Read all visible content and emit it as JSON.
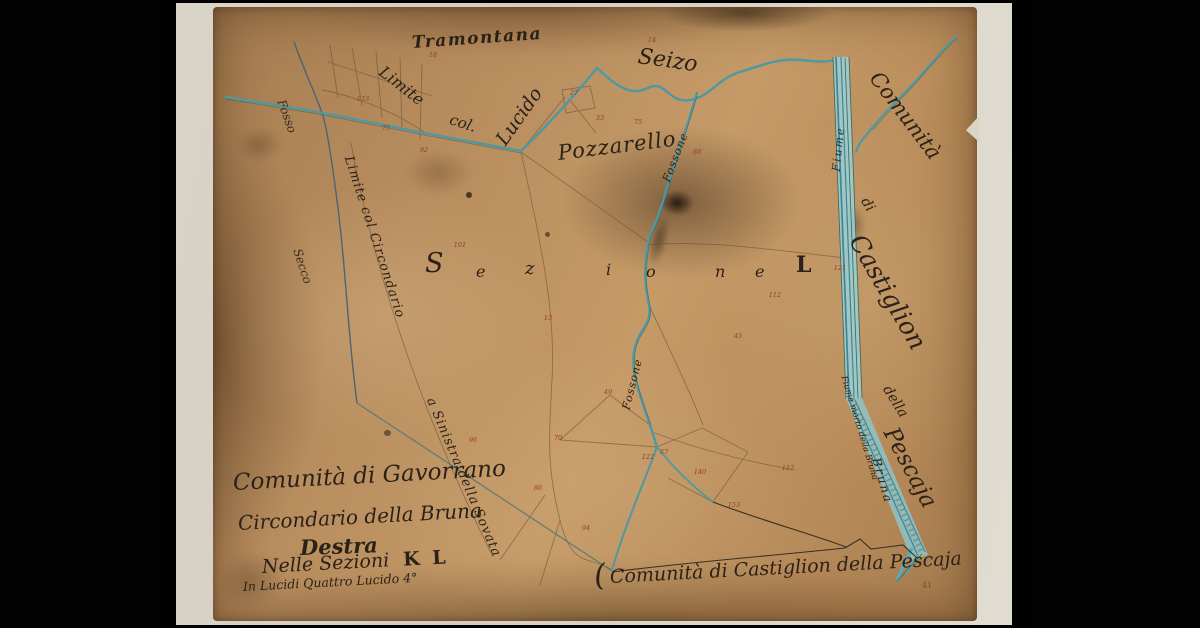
{
  "labels": {
    "tramontana": "Tramontana",
    "limite": "Limite",
    "col": "col.",
    "lucido": "Lucido",
    "seizo": "Seizo",
    "pozzarello": "Pozzarello",
    "fossone_upper": "Fossone",
    "fossone_lower": "Fossone",
    "fosso": "Fosso",
    "secco": "Secco",
    "fiume": "Fiume",
    "sovata_line1": "Limite col Circondario",
    "sovata_line2": "a Sinistra della Sovata",
    "comunita_right": "Comunità",
    "di_right": "di",
    "castiglion_right": "Castiglion",
    "della_right": "della",
    "pescaja_right": "Pescaja",
    "bruna_river": "Bruna",
    "fiume_morto": "Fiume morto della Bruna",
    "bottom_brace": "(",
    "bottom_boundary": "Comunità di Castiglion della Pescaja",
    "corner_mark": "41"
  },
  "sezione_letters": [
    "S",
    "e",
    "z",
    "i",
    "o",
    "n",
    "e",
    "L"
  ],
  "title_block": {
    "line1": "Comunità di Gavorrano",
    "line2": "Circondario della Bruna",
    "line3": "Destra",
    "line4a": "Nelle Sezioni",
    "line4b": "K L",
    "line5": "In Lucidi Quattro Lucido 4°"
  },
  "parcel_numbers": [
    {
      "x": 363,
      "y": 99,
      "v": "133"
    },
    {
      "x": 386,
      "y": 128,
      "v": "75"
    },
    {
      "x": 424,
      "y": 150,
      "v": "92"
    },
    {
      "x": 433,
      "y": 55,
      "v": "18"
    },
    {
      "x": 574,
      "y": 93,
      "v": "27"
    },
    {
      "x": 638,
      "y": 122,
      "v": "75"
    },
    {
      "x": 652,
      "y": 40,
      "v": "14"
    },
    {
      "x": 697,
      "y": 152,
      "v": "88"
    },
    {
      "x": 775,
      "y": 295,
      "v": "112"
    },
    {
      "x": 738,
      "y": 336,
      "v": "45"
    },
    {
      "x": 840,
      "y": 268,
      "v": "121"
    },
    {
      "x": 548,
      "y": 318,
      "v": "13"
    },
    {
      "x": 460,
      "y": 245,
      "v": "101"
    },
    {
      "x": 648,
      "y": 457,
      "v": "122"
    },
    {
      "x": 664,
      "y": 452,
      "v": "57"
    },
    {
      "x": 538,
      "y": 488,
      "v": "86"
    },
    {
      "x": 586,
      "y": 528,
      "v": "94"
    },
    {
      "x": 700,
      "y": 472,
      "v": "140"
    },
    {
      "x": 734,
      "y": 505,
      "v": "153"
    },
    {
      "x": 788,
      "y": 468,
      "v": "117"
    },
    {
      "x": 473,
      "y": 440,
      "v": "96"
    },
    {
      "x": 608,
      "y": 392,
      "v": "49"
    },
    {
      "x": 558,
      "y": 438,
      "v": "70"
    },
    {
      "x": 600,
      "y": 118,
      "v": "33"
    }
  ],
  "colors": {
    "background": "#000000",
    "backing_sheet": "#d8d3c6",
    "paper": "#b3885c",
    "river_teal": "#4e98a4",
    "ink": "#2a2118",
    "parcel_red": "#973a28"
  }
}
